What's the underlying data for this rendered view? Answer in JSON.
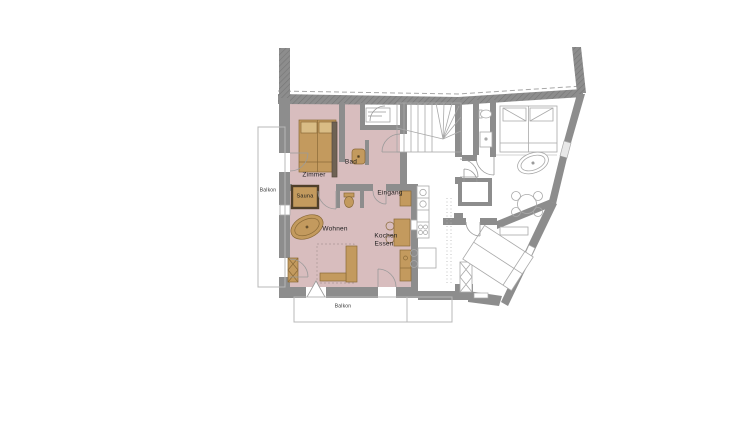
{
  "plan": {
    "type": "apartment-floor-plan",
    "rooms": {
      "zimmer": "Zimmer",
      "bad": "Bad",
      "sauna": "Sauna",
      "wohnen": "Wohnen",
      "eingang": "Eingang",
      "kochen": "Kochen",
      "essen": "Essen"
    },
    "balconies": {
      "left": "Balkon",
      "bottom": "Balkon"
    },
    "colors": {
      "wall_gray": "#8d8d8d",
      "wall_hatch": "#767676",
      "apartment_fill": "#d8bdbe",
      "furniture_tan": "#c39a5e",
      "furniture_tan_light": "#d9bc85",
      "furniture_border": "#8a6a38",
      "sauna_border": "#4f3f2a",
      "wardrobe_dark": "#6e6254",
      "neighbor_outline": "#a9a9a9",
      "door_arc": "#9a9a9a",
      "balcony_outline": "#b8b8b8",
      "label_text": "#1c1c1c"
    }
  }
}
